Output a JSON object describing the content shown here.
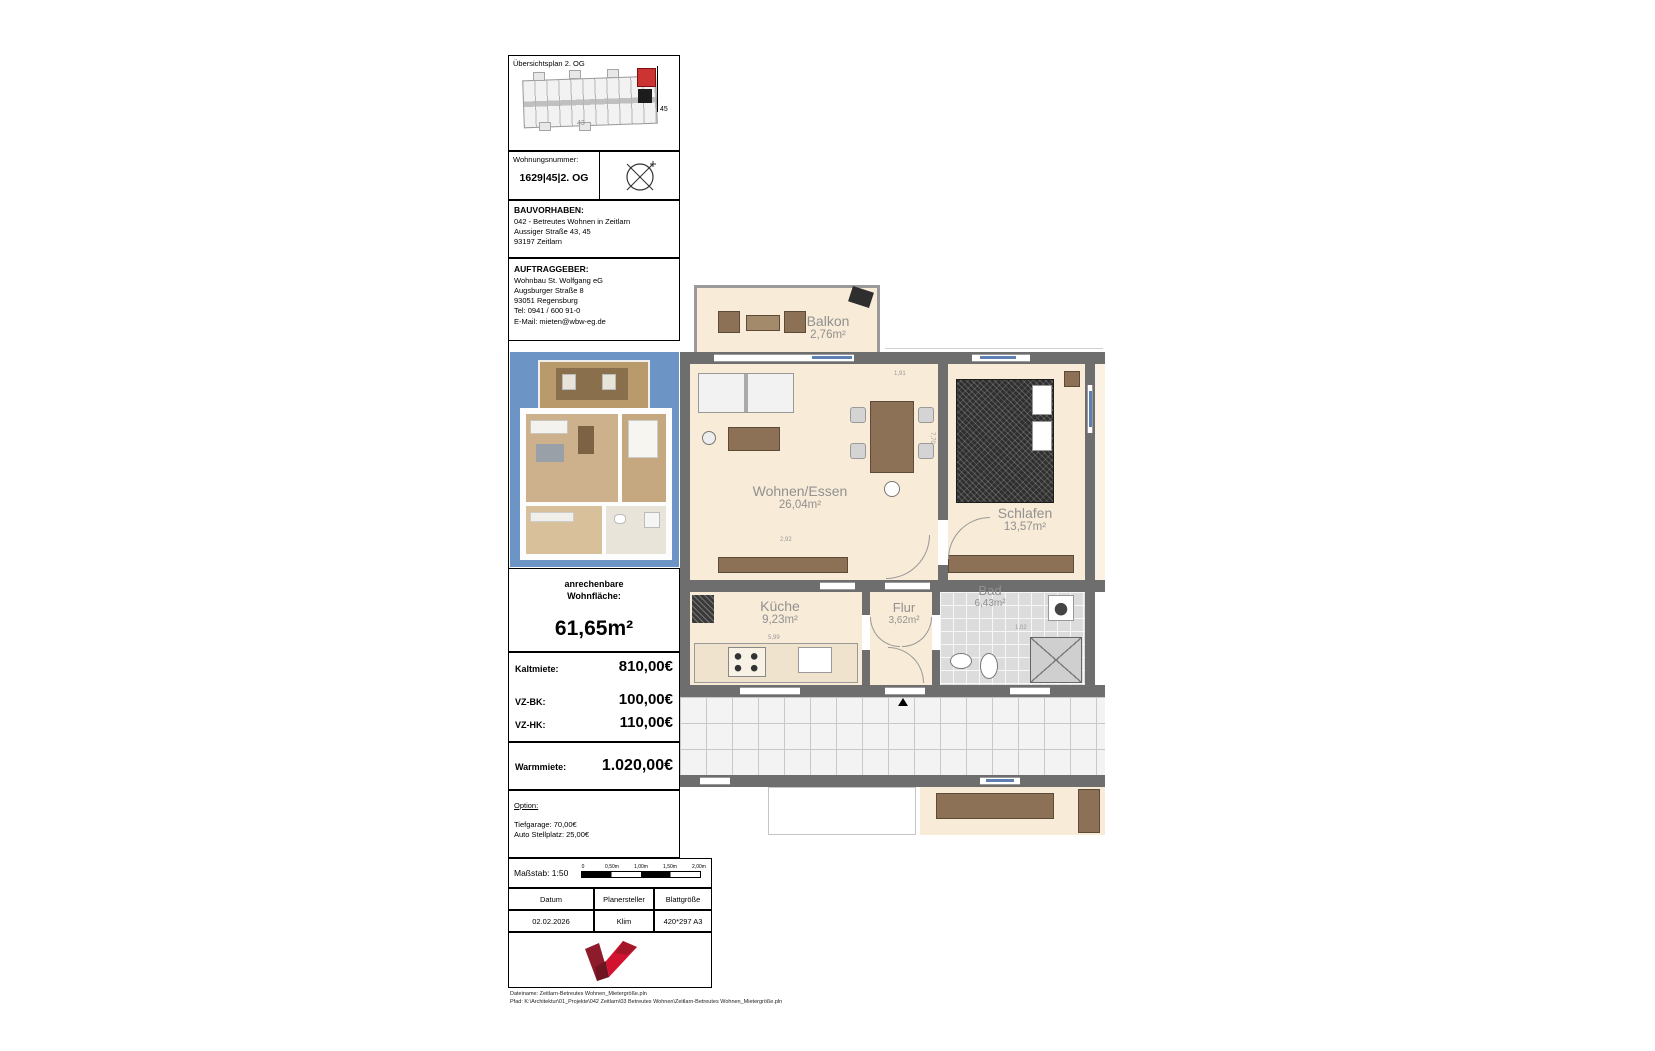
{
  "document": {
    "overview": {
      "title": "Übersichtsplan  2. OG",
      "building_no_left": "43",
      "building_no_right": "45"
    },
    "unit": {
      "label": "Wohnungsnummer:",
      "value": "1629|45|2. OG"
    },
    "bauvorhaben": {
      "heading": "BAUVORHABEN:",
      "line1": "042 - Betreutes Wohnen in Zeitlarn",
      "line2": "Aussiger Straße 43, 45",
      "line3": "93197 Zeitlarn"
    },
    "auftraggeber": {
      "heading": "AUFTRAGGEBER:",
      "line1": "Wohnbau St. Wolfgang eG",
      "line2": "Augsburger Straße 8",
      "line3": "93051 Regensburg",
      "line4": "Tel: 0941 / 600 91-0",
      "line5": "E-Mail: mieten@wbw-eg.de"
    },
    "wohnflaeche": {
      "label": "anrechenbare\nWohnfläche:",
      "value": "61,65m²"
    },
    "prices": {
      "row1_label": "Kaltmiete:",
      "row1_value": "810,00€",
      "row2_label": "VZ-BK:",
      "row2_value": "100,00€",
      "row3_label": "VZ-HK:",
      "row3_value": "110,00€"
    },
    "warmmiete": {
      "label": "Warmmiete:",
      "value": "1.020,00€"
    },
    "option": {
      "heading": "Option:",
      "line1": "Tiefgarage: 70,00€",
      "line2": "Auto Stellplatz: 25,00€"
    },
    "scale": {
      "label": "Maßstab: 1:50",
      "tick0": "0",
      "tick1": "0,50m",
      "tick2": "1,00m",
      "tick3": "1,50m",
      "tick4": "2,00m"
    },
    "meta": {
      "h1": "Datum",
      "h2": "Planersteller",
      "h3": "Blattgröße",
      "v1": "02.02.2026",
      "v2": "Klim",
      "v3": "420*297 A3"
    },
    "footer": {
      "line1": "Dateiname: Zeitlarn-Betreutes Wohnen_Mietergröße.pln",
      "line2": "Pfad: K:\\Architektur\\01_Projekte\\042 Zeitlarn\\03 Betreutes Wohnen\\Zeitlarn-Betreutes Wohnen_Mietergröße.pln"
    }
  },
  "floorplan": {
    "rooms": {
      "balkon": {
        "name": "Balkon",
        "area": "2,76m²"
      },
      "wohnen": {
        "name": "Wohnen/Essen",
        "area": "26,04m²"
      },
      "schlafen": {
        "name": "Schlafen",
        "area": "13,57m²"
      },
      "kueche": {
        "name": "Küche",
        "area": "9,23m²"
      },
      "flur": {
        "name": "Flur",
        "area": "3,62m²"
      },
      "bad": {
        "name": "Bad",
        "area": "6,43m²"
      }
    },
    "dims": {
      "d1": "1,91",
      "d2": "7,70",
      "d3": "2,92",
      "d4": "5,99",
      "d5": "1,02"
    }
  },
  "colors": {
    "accent_red": "#d2122e",
    "logo_dark": "#8e1b2c",
    "wall_gray": "#6e6e6e",
    "floor_cream": "#f8ebd7",
    "visual_bg": "#6c95c6",
    "highlight_unit": "#cc3333"
  }
}
